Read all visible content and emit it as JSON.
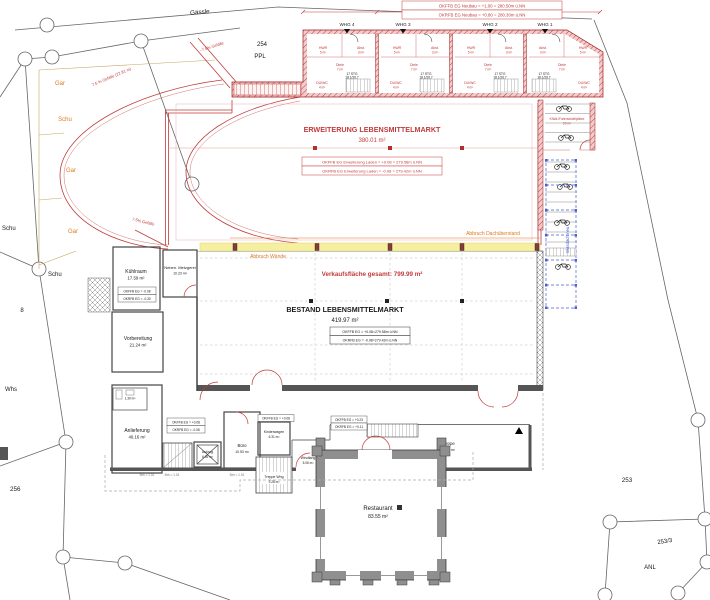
{
  "colors": {
    "new_red": "#c23b3b",
    "demolition_yellow": "#f6efa0",
    "abbruch_orange": "#e07820",
    "glass_blue": "#4a5fd0",
    "existing_gray": "#8f8f8f",
    "garage_tan": "#c8a464"
  },
  "site": {
    "street": "Gässle",
    "parcel_number": "254",
    "parcel_use": "PPL",
    "plots": {
      "p256": "256",
      "p253": "253",
      "p253_3": "253/3",
      "anl": "ANL",
      "p8": "8",
      "whs": "Whs",
      "schu_a": "Schu",
      "schu_b": "Schu"
    },
    "garage_labels": {
      "g1": "Gar",
      "s1": "Schu",
      "g2": "Gar",
      "g3": "Gar"
    },
    "slopes": {
      "curve": "7.5 % Gefälle (22.81 m)",
      "top": "~7.5% Gefälle",
      "bottom": "7.5% Gefälle"
    }
  },
  "neubau": {
    "level_box": [
      "OKFFB EG Neubau = +1.00 = 280.50m ü.NN",
      "OKRFB EG Neubau = +0.80 = 280.30m ü.NN"
    ],
    "whg": [
      "WHG 4",
      "WHG 3",
      "WHG 2",
      "WHG 1"
    ],
    "room_labels": {
      "hwr": "HWR",
      "hwr_area": "5 m²",
      "abst": "Abst.",
      "abst_area": "3 m²",
      "diele": "Diele",
      "diele_area": "7 m²",
      "duwc": "DU/WC",
      "duwc_area": "4 m²",
      "stair_steps": "17 STG",
      "stair_dim": "18.1/26.7"
    }
  },
  "erweiterung": {
    "title": "ERWEITERUNG LEBENSMITTELMARKT",
    "area": "380.01 m²",
    "level_box": [
      "OKFFB EG Erweiterung Laden = +0.08 = 279.58m ü.NN",
      "OKRFB EG Erweiterung Laden = -0.08 = 279.42m ü.NN"
    ]
  },
  "abbruch": {
    "dach": "Abbruch Dachüberstand",
    "waende": "Abbruch Wände"
  },
  "verkauf": {
    "total": "Verkaufsfläche gesamt: 799.99 m²"
  },
  "bestand": {
    "title": "BESTAND LEBENSMITTELMARKT",
    "area": "419.97 m²",
    "level_box": [
      "OKFFB EG = +0.08=279.58m ü.NN",
      "OKRFB EG = -0.08=279.42m ü.NN"
    ]
  },
  "rooms": {
    "kuehlraum": {
      "name": "Kühlraum",
      "area": "17.59 m²",
      "box": [
        "OKFFB EG = -0.08",
        "OKRFB EG = -0.30"
      ]
    },
    "metzgerei": {
      "name": "Neben. Metzgerei",
      "area": "10.23 m²"
    },
    "vorbereitung": {
      "name": "Vorbereitung",
      "area": "21.24 m²"
    },
    "anlieferung": {
      "name": "Anlieferung",
      "area": "40.16 m²",
      "box": [
        "OKFFB EG = +0.08",
        "OKRFB EG = -0.08"
      ]
    },
    "wc": {
      "name": "WC",
      "area": "1.39 m²"
    },
    "aufzug": {
      "name": "Aufzug",
      "area": "6.39 m²"
    },
    "buero": {
      "name": "Büro",
      "area": "10.53 m²"
    },
    "kinderwagen": {
      "name": "Kinderwagen",
      "area": "6.31 m²",
      "box": [
        "OKFFB EG = +0.08"
      ]
    },
    "windfang": {
      "name": "Windfang",
      "area": "5.06 m²"
    },
    "treppe_whg": {
      "name": "Treppe Whg",
      "area": "9.28 m²"
    },
    "treppe": {
      "name": "Treppe",
      "area": "25.26 m²",
      "box": [
        "OKFFB EG = +0.23",
        "OKRFB EG = +0.11"
      ]
    },
    "restaurant": {
      "name": "Restaurant",
      "area": "83.55 m²"
    }
  },
  "aussen": {
    "bike_label": "KiWa-/Fahrradstellplätze",
    "bike_area": "20 m²",
    "glasdach": "Glasdach neu",
    "brh": "Brh = 1.01"
  }
}
